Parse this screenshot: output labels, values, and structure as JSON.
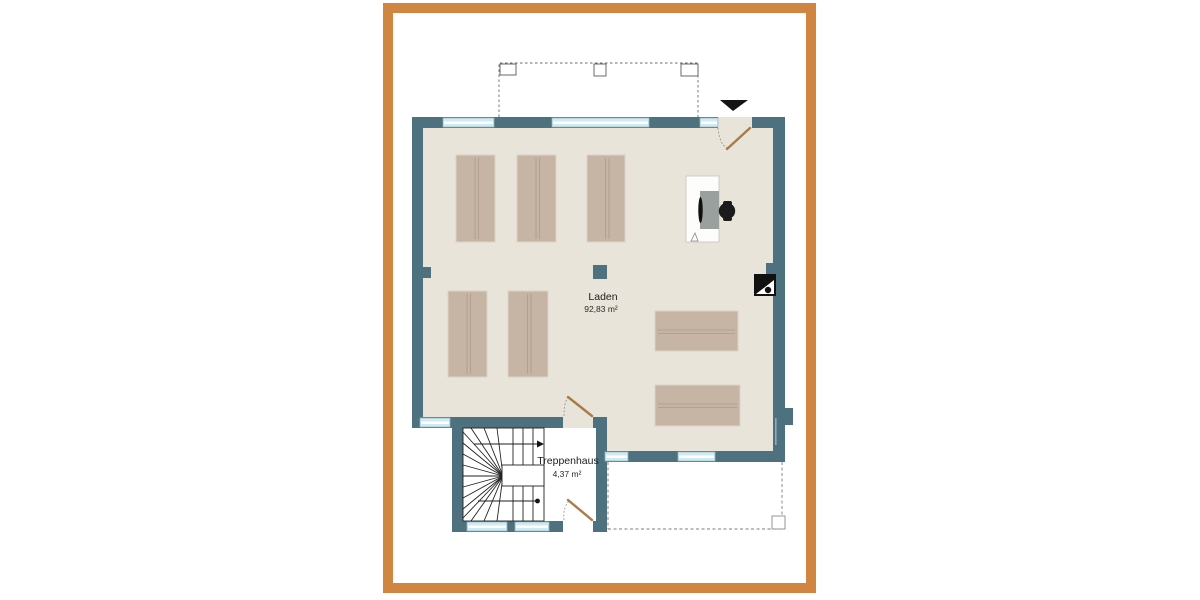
{
  "plan": {
    "type": "architectural-floor-plan",
    "rooms": [
      {
        "name": "Laden",
        "area": "92,83 m²"
      },
      {
        "name": "Treppenhaus",
        "area": "4,37 m²"
      }
    ],
    "furniture": {
      "shelf_units_vertical_top": 3,
      "shelf_units_vertical_bottom_left": 2,
      "shelf_units_horizontal_right": 2,
      "desk_with_office_chair": 1
    },
    "symbols": {
      "entrance_marker": "black-triangle-down",
      "chimney_icon": "black-square-white-triangle-dot",
      "stairs_direction": "arrow-right-up-run",
      "stairs_start": "dot",
      "canopy_outline": "dashed-rectangle-with-three-posts",
      "terrace_outline": "dashed-rectangle-with-corner-post",
      "structural_column": "small-square"
    },
    "palette": {
      "frame_orange": "#d08540",
      "wall_teal": "#4e717f",
      "floor_beige": "#e8e4da",
      "window_glass": "#cfeaf2",
      "shelf_tan": "#c6b5a5",
      "door_leaf_brown": "#a87c45",
      "stair_lines": "#222222"
    }
  }
}
